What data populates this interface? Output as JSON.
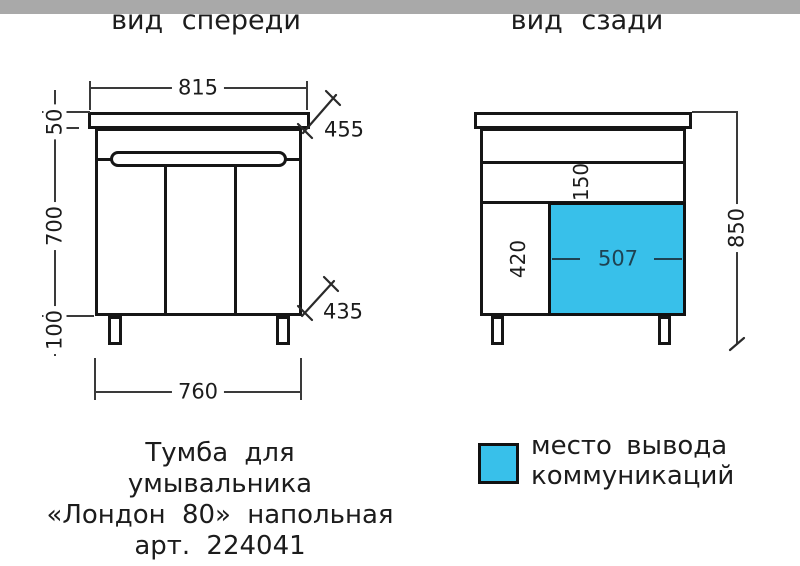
{
  "front": {
    "title": "вид спереди",
    "top_width": "815",
    "counter_depth": "455",
    "counter_thickness": "50",
    "body_height": "700",
    "leg_height": "100",
    "body_depth": "435",
    "bottom_width": "760"
  },
  "back": {
    "title": "вид сзади",
    "back_rail_height": "150",
    "outlet_zone_height": "420",
    "outlet_zone_width": "507",
    "total_height": "850"
  },
  "legend": {
    "label_line1": "место вывода",
    "label_line2": "коммуникаций"
  },
  "caption": {
    "line1": "Тумба для",
    "line2": "умывальника",
    "line3": "«Лондон 80» напольная",
    "line4": "арт. 224041"
  },
  "colors": {
    "highlight": "#38c0ea",
    "floor": "#a9a9a9",
    "dim_text_on_highlight": "#1e4252"
  }
}
